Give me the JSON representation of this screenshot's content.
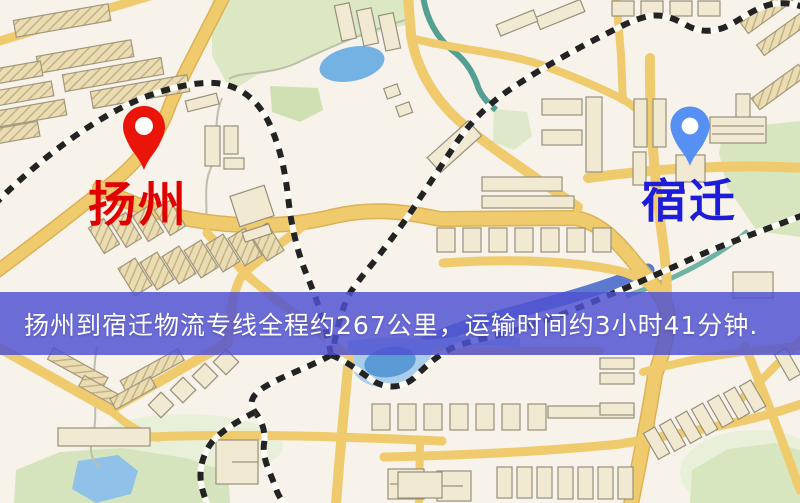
{
  "map": {
    "origin": {
      "label": "扬州",
      "label_color": "#e10000",
      "pin_color": "#ea1409"
    },
    "destination": {
      "label": "宿迁",
      "label_color": "#1c1cd9",
      "pin_color": "#5590f2"
    },
    "palette": {
      "background": "#f7f2ea",
      "road_yellow": "#efcb6e",
      "park_green": "#dce8c4",
      "water_blue": "#74b2e4",
      "river_blue": "#5b79cf",
      "railway_black": "#232323",
      "building_fill": "#f2e9d2"
    }
  },
  "banner": {
    "text": "扬州到宿迁物流专线全程约267公里，运输时间约3小时41分钟.",
    "background": "#5052d0",
    "text_color": "#ffffff"
  },
  "route": {
    "origin": "扬州",
    "destination": "宿迁",
    "service": "物流专线",
    "distance": "约267公里",
    "duration": "约3小时41分钟"
  }
}
